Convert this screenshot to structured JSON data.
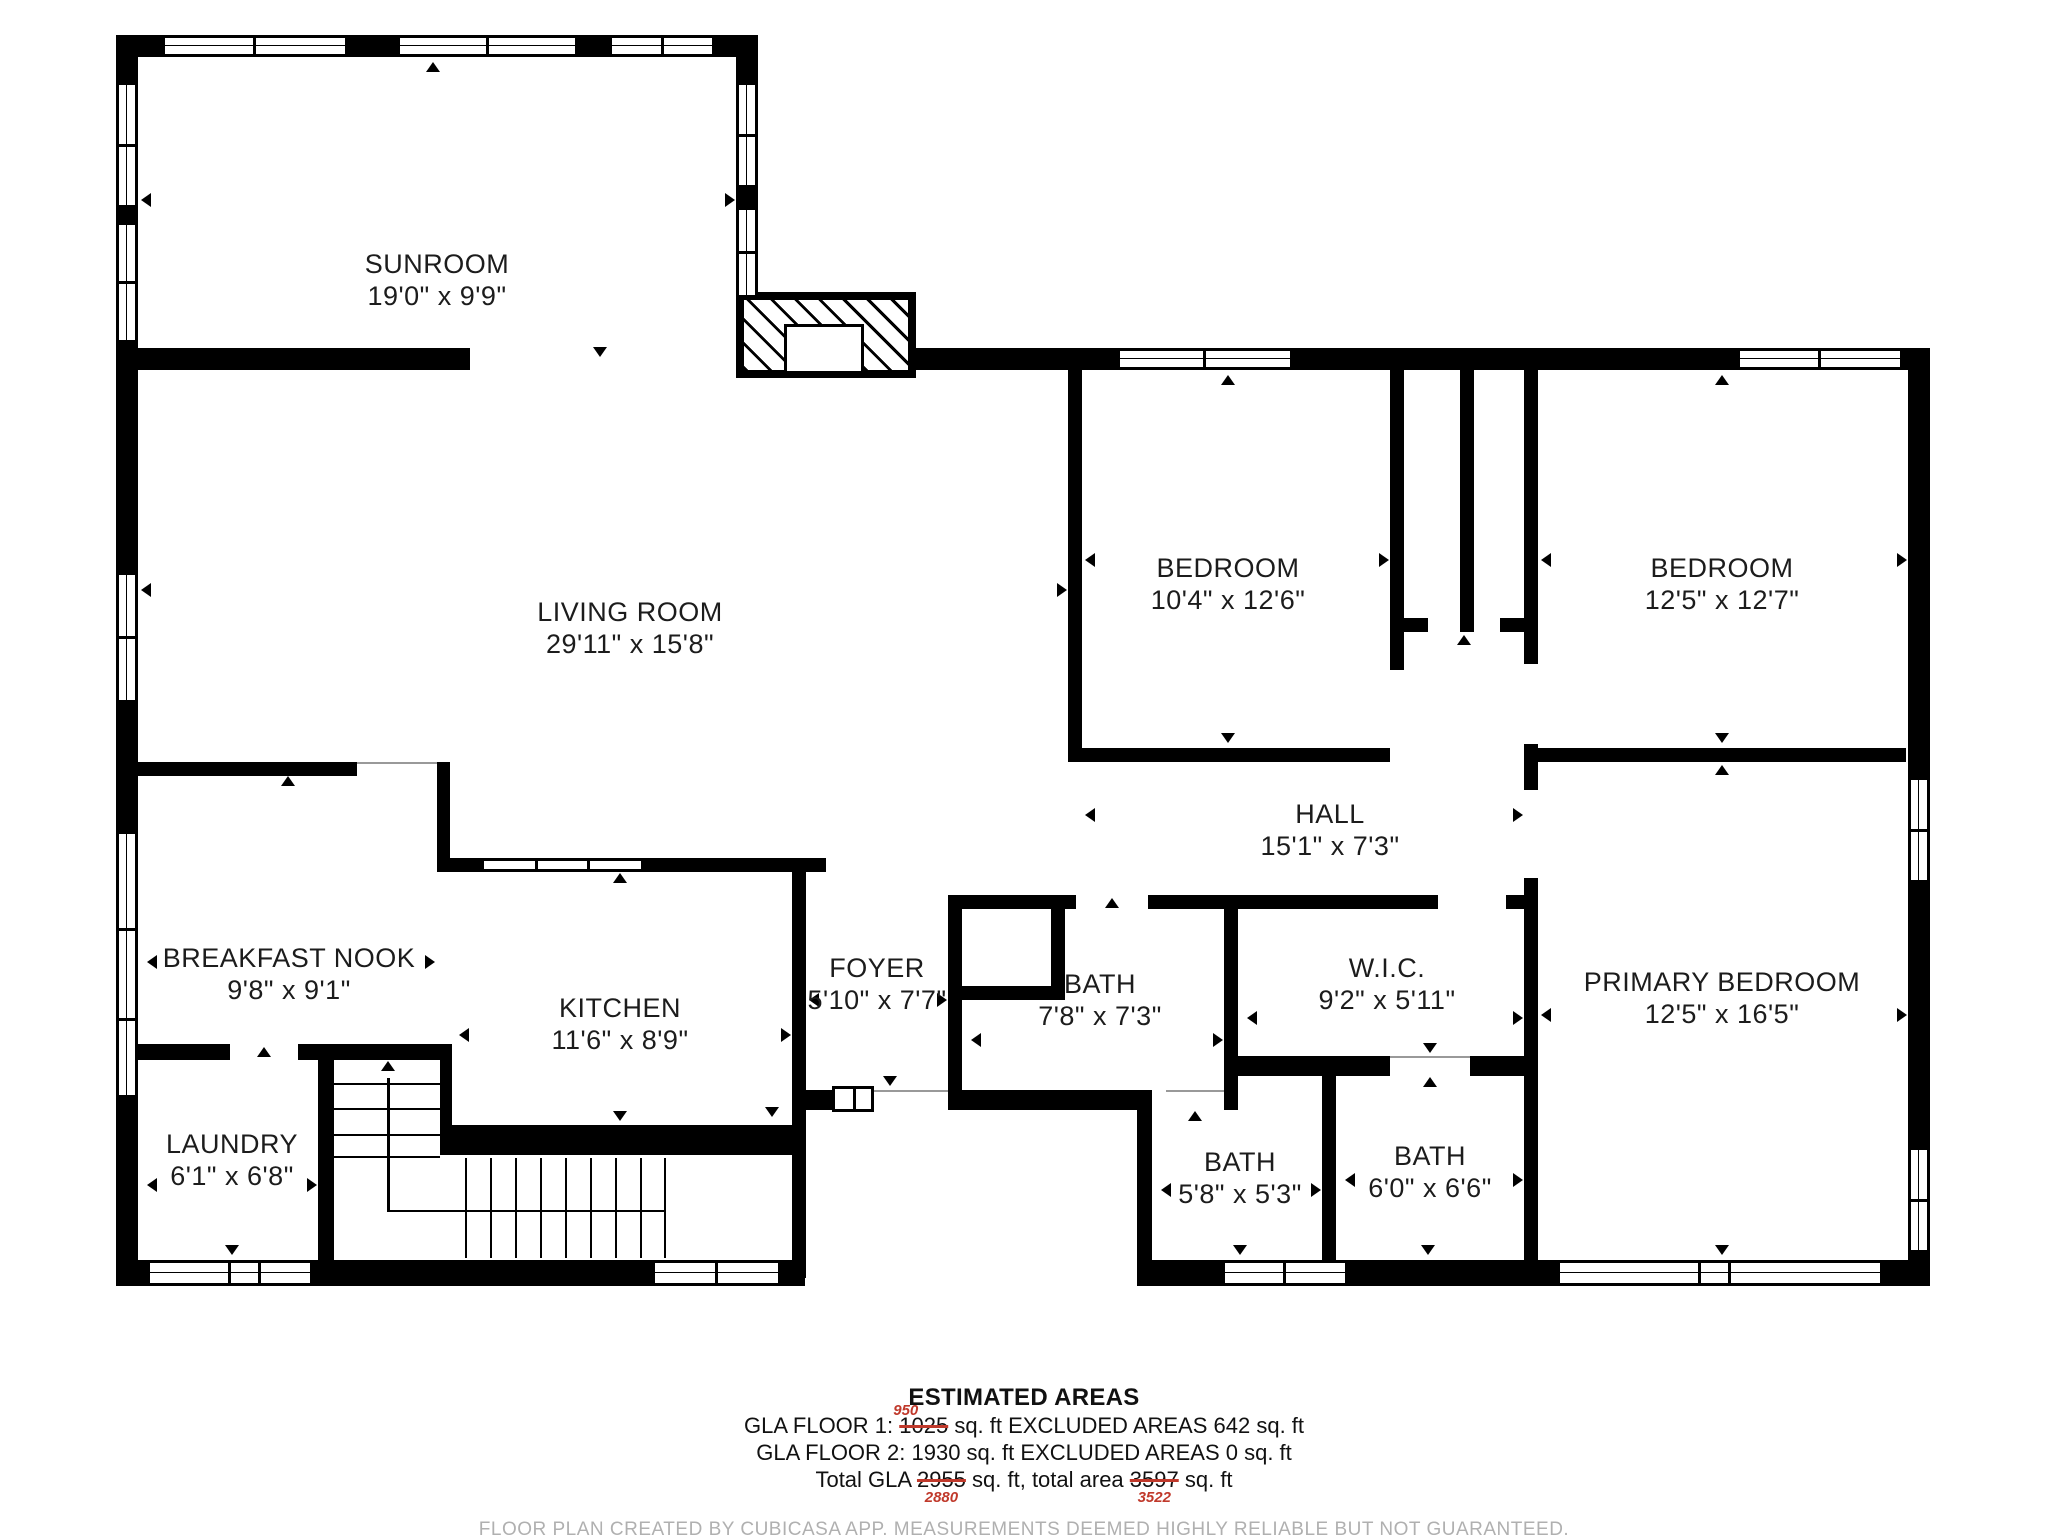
{
  "colors": {
    "wall": "#000000",
    "correction_red": "#c0392b",
    "disclaimer_gray": "#b0b0b0"
  },
  "rooms": [
    {
      "id": "sunroom",
      "name": "SUNROOM",
      "dims": "19'0\" x 9'9\""
    },
    {
      "id": "living-room",
      "name": "LIVING ROOM",
      "dims": "29'11\" x 15'8\""
    },
    {
      "id": "bedroom-1",
      "name": "BEDROOM",
      "dims": "10'4\" x 12'6\""
    },
    {
      "id": "bedroom-2",
      "name": "BEDROOM",
      "dims": "12'5\" x 12'7\""
    },
    {
      "id": "hall",
      "name": "HALL",
      "dims": "15'1\" x 7'3\""
    },
    {
      "id": "breakfast-nook",
      "name": "BREAKFAST NOOK",
      "dims": "9'8\" x 9'1\""
    },
    {
      "id": "kitchen",
      "name": "KITCHEN",
      "dims": "11'6\" x 8'9\""
    },
    {
      "id": "foyer",
      "name": "FOYER",
      "dims": "5'10\" x 7'7\""
    },
    {
      "id": "bath-main",
      "name": "BATH",
      "dims": "7'8\" x 7'3\""
    },
    {
      "id": "wic",
      "name": "W.I.C.",
      "dims": "9'2\" x 5'11\""
    },
    {
      "id": "primary-bedroom",
      "name": "PRIMARY BEDROOM",
      "dims": "12'5\" x 16'5\""
    },
    {
      "id": "laundry",
      "name": "LAUNDRY",
      "dims": "6'1\" x 6'8\""
    },
    {
      "id": "bath-small",
      "name": "BATH",
      "dims": "5'8\" x 5'3\""
    },
    {
      "id": "bath-hall",
      "name": "BATH",
      "dims": "6'0\" x 6'6\""
    }
  ],
  "footer": {
    "title": "ESTIMATED AREAS",
    "floor1_prefix": "GLA FLOOR 1: ",
    "floor1_old": "1025",
    "floor1_new": "950",
    "floor1_suffix": " sq. ft EXCLUDED AREAS 642 sq. ft",
    "floor2": "GLA FLOOR 2: 1930 sq. ft EXCLUDED AREAS 0 sq. ft",
    "total_prefix": "Total GLA ",
    "total_old": "2955",
    "total_new": "2880",
    "total_mid": " sq. ft, total area ",
    "area_old": "3597",
    "area_new": "3522",
    "total_suffix": " sq. ft",
    "disclaimer": "FLOOR PLAN CREATED BY CUBICASA APP. MEASUREMENTS DEEMED HIGHLY RELIABLE BUT NOT GUARANTEED."
  }
}
